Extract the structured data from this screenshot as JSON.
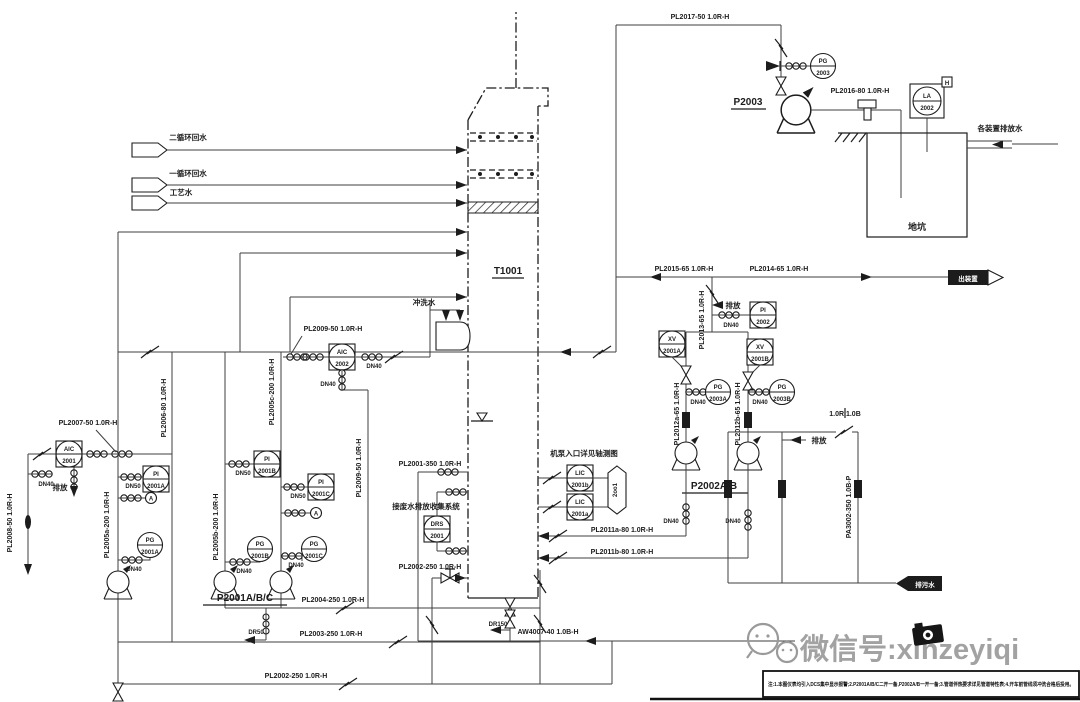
{
  "colors": {
    "ink": "#1c1c1c",
    "pipe": "#3f3f3f",
    "watermark": "#969696"
  },
  "labels": {
    "pl2017": "PL2017-50 1.0R-H",
    "pl2016": "PL2016-80 1.0R-H",
    "pl2015": "PL2015-65 1.0R-H",
    "pl2014": "PL2014-65 1.0R-H",
    "pl2013": "PL2013-65 1.0R-H",
    "pl2012a": "PL2012a-65 1.0R-H",
    "pl2012b": "PL2012b-65 1.0R-H",
    "pl2011a": "PL2011a-80 1.0R-H",
    "pl2011b": "PL2011b-80 1.0R-H",
    "pl2009": "PL2009-50 1.0R-H",
    "pl2008": "PL2008-50 1.0R-H",
    "pl2007": "PL2007-50 1.0R-H",
    "pl2006": "PL2006-80 1.0R-H",
    "pl2005a": "PL2005a-200 1.0R-H",
    "pl2005b": "PL2005b-200 1.0R-H",
    "pl2005c": "PL2005c-200 1.0R-H",
    "pl2004": "PL2004-250 1.0R-H",
    "pl2003": "PL2003-250 1.0R-H",
    "pl2002": "PL2002-250 1.0R-H",
    "pl2001": "PL2001-350 1.0R-H",
    "pa3002": "PA3002-350 1.0B-P",
    "aw4007": "AW4007-40 1.0B-H",
    "spec_break": "1.0R 1.0B"
  },
  "equipment": {
    "column": "T1001",
    "p2001": "P2001A/B/C",
    "p2002": "P2002A/B",
    "p2003": "P2003",
    "pit": "地坑"
  },
  "inst": {
    "pg2003": {
      "l1": "PG",
      "l2": "2003"
    },
    "la2002": {
      "l1": "LA",
      "l2": "2002",
      "flag": "H"
    },
    "pi2002": {
      "l1": "PI",
      "l2": "2002"
    },
    "xv2001a": {
      "l1": "XV",
      "l2": "2001A"
    },
    "xv2001b": {
      "l1": "XV",
      "l2": "2001B"
    },
    "pg2003a": {
      "l1": "PG",
      "l2": "2003A"
    },
    "pg2003b": {
      "l1": "PG",
      "l2": "2003B"
    },
    "lic2001a": {
      "l1": "LIC",
      "l2": "2001a"
    },
    "lic2001b": {
      "l1": "LIC",
      "l2": "2001b"
    },
    "drs2001": {
      "l1": "DRS",
      "l2": "2001"
    },
    "aic2001": {
      "l1": "AIC",
      "l2": "2001"
    },
    "aic2002": {
      "l1": "AIC",
      "l2": "2002"
    },
    "pi2001a": {
      "l1": "PI",
      "l2": "2001A"
    },
    "pi2001b": {
      "l1": "PI",
      "l2": "2001B"
    },
    "pi2001c": {
      "l1": "PI",
      "l2": "2001C"
    },
    "pg2001a": {
      "l1": "PG",
      "l2": "2001A"
    },
    "pg2001b": {
      "l1": "PG",
      "l2": "2001B"
    },
    "pg2001c": {
      "l1": "PG",
      "l2": "2001C"
    },
    "sample": {
      "label": "A"
    },
    "logic": {
      "label": "2oo1"
    }
  },
  "sizes": {
    "dn40": "DN40",
    "dn50": "DN50",
    "dr50": "DR50",
    "dr150": "DR150"
  },
  "streams": {
    "feed1": "二循环回水",
    "feed2": "一循环回水",
    "feed3": "工艺水",
    "wash": "冲洗水",
    "pit_inlet": "各装置排放水",
    "vent": "排放",
    "out_right": "出装置",
    "out_blowdown": "排污水"
  },
  "notes": {
    "drs_note": "接废水排放收集系统",
    "pump_note": "机泵入口详见轴测图",
    "bottom_bar": "注:1.本图仪表均引入DCS集中显示报警;2.P2001A/B/C二开一备,P2002A/B一开一备;3.管道伴热要求详见管道特性表;4.开车前管线须冲洗合格后投用。"
  },
  "watermark": {
    "text": "微信号:xinzeyiqi"
  }
}
